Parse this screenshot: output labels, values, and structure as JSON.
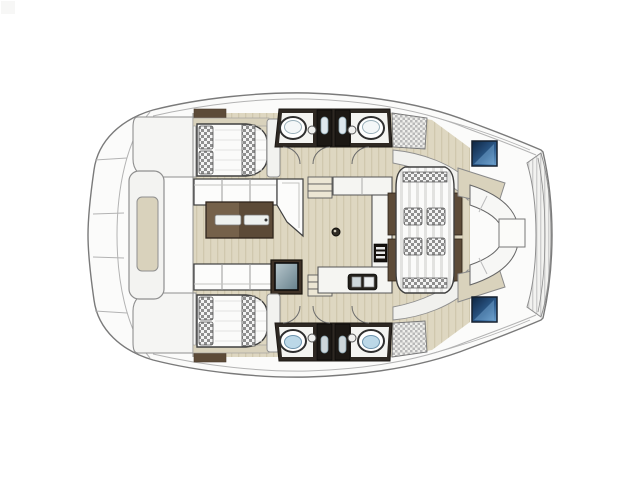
{
  "meta": {
    "title": "catamaran-deck-floor-plan",
    "view": "top-down",
    "description_semantic": "line-drawing floor plan of a sailing catamaran: forward deck lounge (left), two mirrored double cabins with beds, two mirrored bathrooms with twin sinks and showers, central saloon with facing sofas and coffee table, galley with counters, aft cockpit with striped lounge pad and U-shaped bench seating (right)"
  },
  "colors": {
    "bg": "#ffffff",
    "hull": "#fbfbfa",
    "hullline": "#7a7a7a",
    "lineLight": "#b3b3b3",
    "lineMid": "#8f8f8f",
    "ink": "#3f3f3f",
    "floor": "#ded7c1",
    "floorStripe": "#d0c8ae",
    "tan": "#d9d2bc",
    "wood": "#75614a",
    "woodDark": "#5c4a37",
    "woodRail": "#5d4b38",
    "wall": "#2e2822",
    "wallDeep": "#1c1814",
    "whiteSoft": "#f4f4f1",
    "checker": "#8f8f8f",
    "checkerBase": "#f4f4f4",
    "weave": "#b8b8b8",
    "weaveBase": "#efefec",
    "padStripe": "#e2e2e0",
    "padBase": "#fbfbfa",
    "navy1": "#0d2440",
    "navy2": "#2e5d8f",
    "navy3": "#6ea3d0",
    "aquaSink": "#bcd8e8",
    "steel": "#cdd6da",
    "screen1": "#b8c7cd",
    "screen2": "#66808b",
    "tray": "#eef1ef",
    "step": "#ece6d4",
    "cornerMark": "#f7f7f6"
  },
  "legend": [
    {
      "name": "foredeck-lounge"
    },
    {
      "name": "cabin-top"
    },
    {
      "name": "cabin-bottom"
    },
    {
      "name": "bathroom-top"
    },
    {
      "name": "bathroom-bottom"
    },
    {
      "name": "saloon-sofas-and-table"
    },
    {
      "name": "galley"
    },
    {
      "name": "cockpit-lounge-pad"
    },
    {
      "name": "aft-bench-and-table"
    },
    {
      "name": "hull-windows"
    }
  ]
}
